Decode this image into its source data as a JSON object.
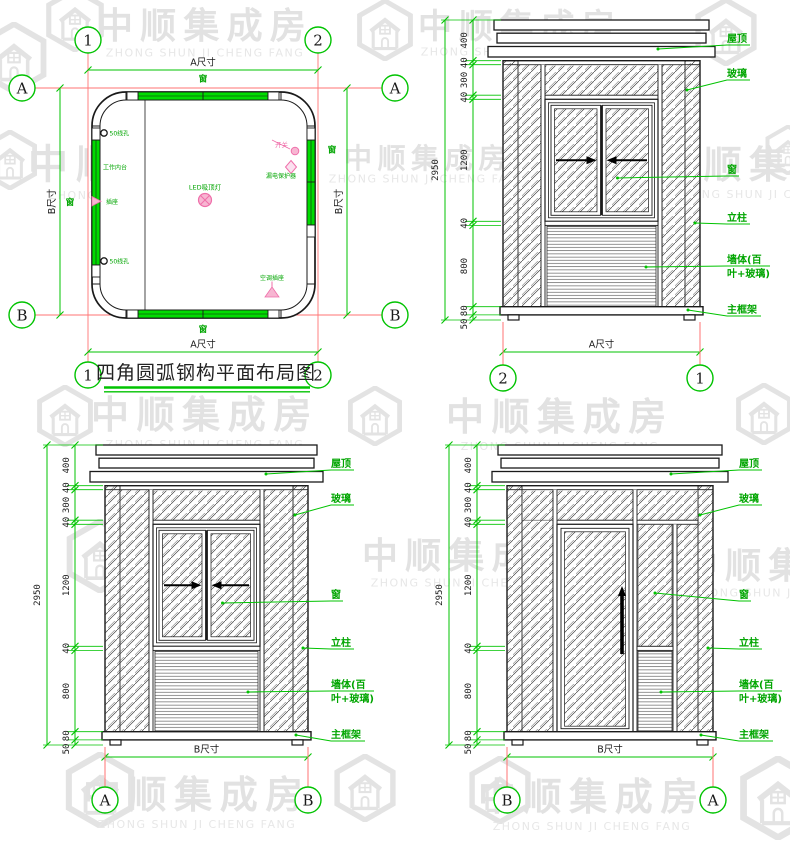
{
  "watermark": {
    "cn": "中顺集成房",
    "en": "ZHONG SHUN JI CHENG FANG"
  },
  "title": "四角圆弧钢构平面布局图",
  "grid_bubbles": {
    "g1": "1",
    "g2": "2",
    "ga": "A",
    "gb": "B"
  },
  "dims": {
    "d400": "400",
    "d40": "40",
    "d300": "300",
    "d1200": "1200",
    "d800": "800",
    "d80": "80",
    "d50": "50",
    "total": "2950",
    "a_size": "A尺寸",
    "b_size": "B尺寸"
  },
  "callouts": {
    "roof": "屋顶",
    "glass": "玻璃",
    "window": "窗",
    "column": "立柱",
    "wall_line1": "墙体(百",
    "wall_line2": "叶+玻璃)",
    "main_frame": "主框架"
  },
  "plan": {
    "window": "窗",
    "led_light": "LED吸顶灯",
    "switch": "开关",
    "breaker": "漏电保护器",
    "ac_socket": "空调插座",
    "socket": "插座",
    "worktop": "工作内台",
    "wire_hole": "50线孔"
  }
}
